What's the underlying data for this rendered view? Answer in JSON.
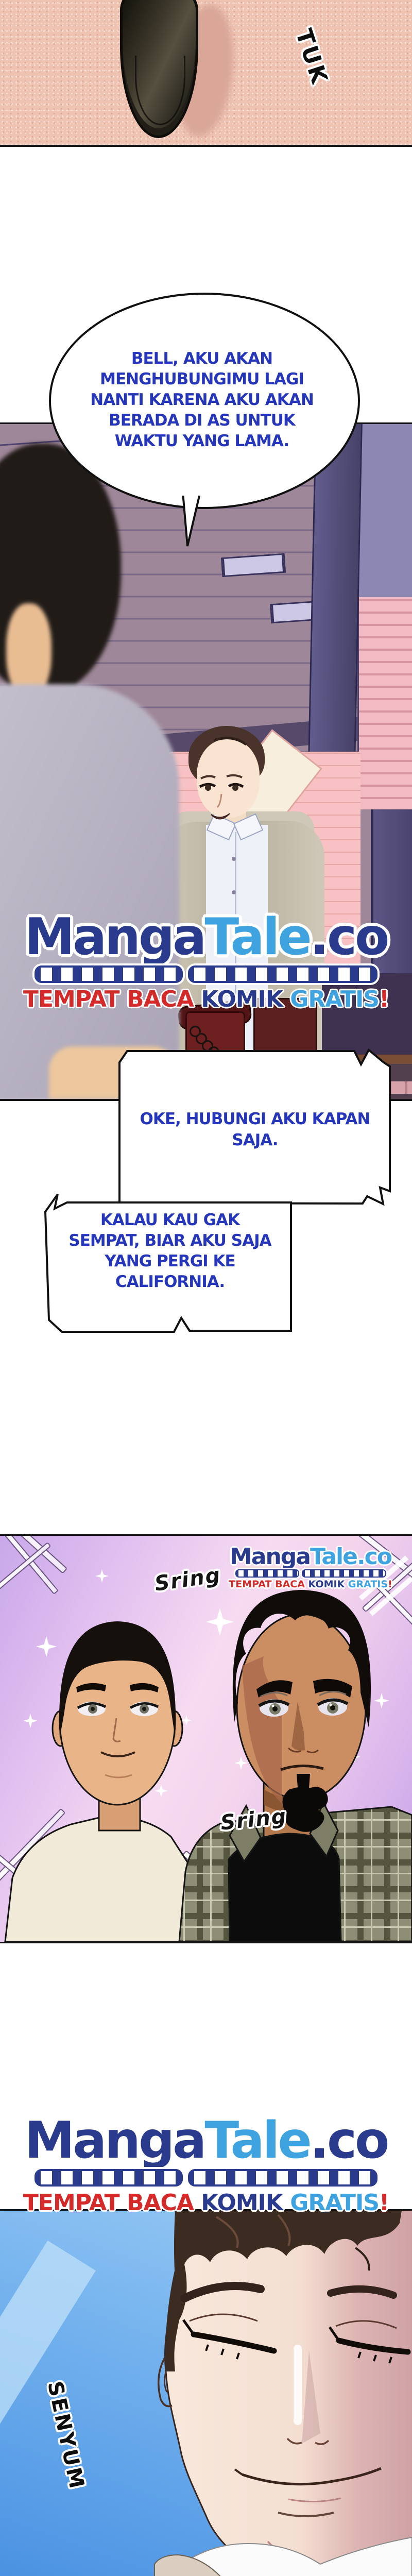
{
  "page": {
    "type": "webtoon-comic-strip",
    "language": "Indonesian"
  },
  "sfx": {
    "tuk": "TUK",
    "sring_top": "Sring",
    "sring_middle": "Sring",
    "senyum": "SENYUM"
  },
  "bubbles": {
    "bubble1": {
      "lines": [
        "BELL, AKU AKAN",
        "MENGHUBUNGIMU LAGI",
        "NANTI KARENA AKU AKAN",
        "BERADA DI AS UNTUK",
        "WAKTU YANG LAMA."
      ]
    },
    "bubble2": {
      "lines": [
        "OKE, HUBUNGI AKU KAPAN",
        "SAJA."
      ]
    },
    "bubble3": {
      "lines": [
        "KALAU KAU GAK",
        "SEMPAT, BIAR AKU SAJA",
        "YANG PERGI KE",
        "CALIFORNIA."
      ]
    }
  },
  "brand": {
    "manga": "Manga",
    "tale": "Tale",
    "domain": ".co",
    "tagline": {
      "tempat_baca": "TEMPAT BACA ",
      "komik": "KOMIK",
      "gratis": " GRATIS",
      "exclaim": "!"
    }
  },
  "colors": {
    "brand_navy": "#2a3a8c",
    "brand_blue": "#3fa3e0",
    "brand_red": "#d42a2a",
    "speech_blue": "#2536bb",
    "panel_outline": "#141414",
    "carpet_pink": "#efc3b2",
    "door_lavender": "#aba2d2",
    "friends_bg_pink": "#f3d4ec",
    "sky_blue": "#4a92e2"
  }
}
